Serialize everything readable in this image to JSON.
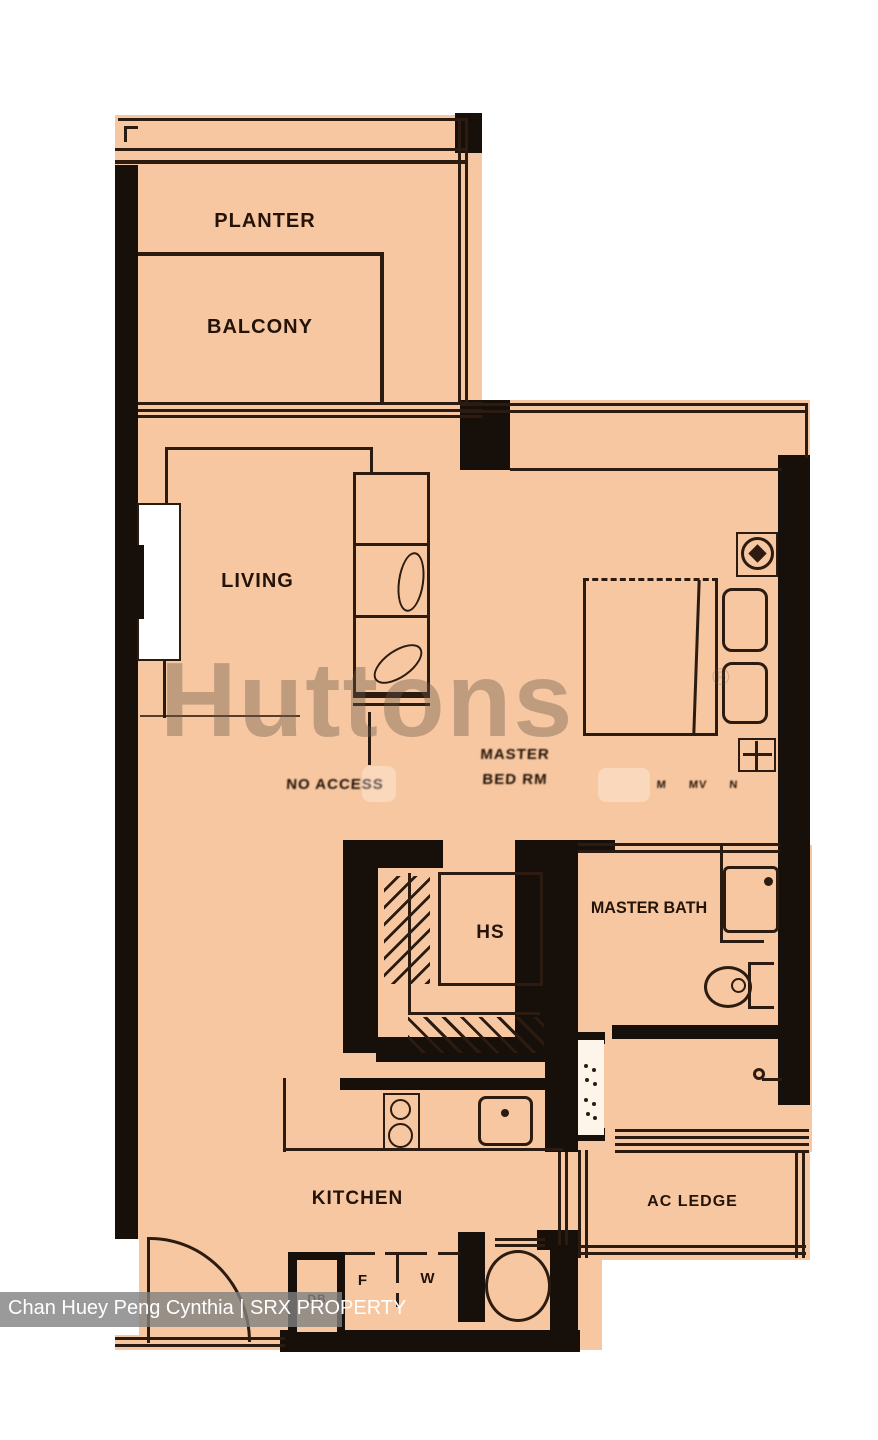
{
  "palette": {
    "bg": "#ffffff",
    "floor": "#f6c7a0",
    "wall": "#17100a",
    "line": "#2b1b10",
    "watermark": "rgba(104,87,74,0.38)",
    "caption_bar": "rgba(129,129,129,0.8)",
    "caption_text": "#ffffff",
    "label": "#241309"
  },
  "watermark": {
    "brand": "Huttons",
    "registered": "®"
  },
  "caption": {
    "agent": "Chan Huey Peng Cynthia | SRX PROPERTY"
  },
  "labels": {
    "planter": "PLANTER",
    "balcony": "BALCONY",
    "living": "LIVING",
    "passage_distorted": "NO ACCESS",
    "master_bed_line1": "MASTER",
    "master_bed_line2": "BED RM",
    "bedroom_marks": "M MV N",
    "hs": "HS",
    "master_bath": "MASTER BATH",
    "kitchen": "KITCHEN",
    "ac_ledge": "AC LEDGE",
    "db": "DB",
    "fridge": "F",
    "washer": "W"
  }
}
